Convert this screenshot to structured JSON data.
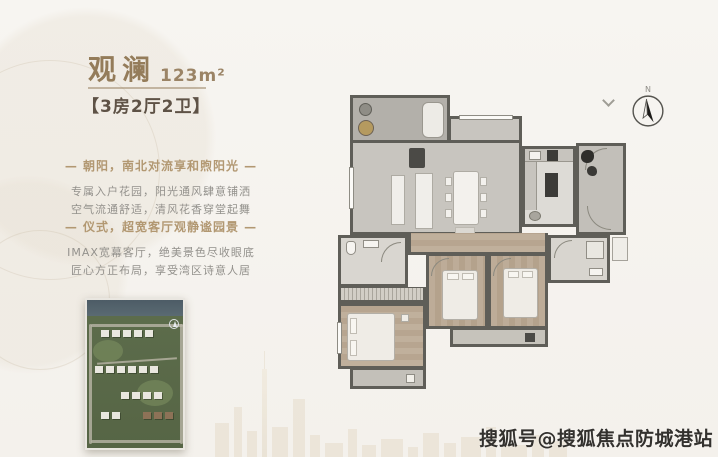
{
  "unit": {
    "name": "观澜",
    "area": "123m²"
  },
  "layout_label": "【3房2厅2卫】",
  "features": [
    {
      "heading": "— 朝阳，南北对流享和煦阳光 —",
      "line1": "专属入户花园，阳光通风肆意铺洒",
      "line2": "空气流通舒适，清风花香穿堂起舞"
    },
    {
      "heading": "— 仪式，超宽客厅观静谧园景 —",
      "line1": "IMAX宽幕客厅，绝美景色尽收眼底",
      "line2": "匠心方正布局，享受湾区诗意人居"
    }
  ],
  "floorplan": {
    "compass_label": "N"
  },
  "watermark": "搜狐号@搜狐焦点防城港站",
  "colors": {
    "accent": "#947c5a",
    "feature_heading": "#b29872",
    "body_text": "#93918c",
    "walls": "#5f5e58",
    "wood_floor": "#b7a590",
    "background": "#f6f4f0"
  }
}
